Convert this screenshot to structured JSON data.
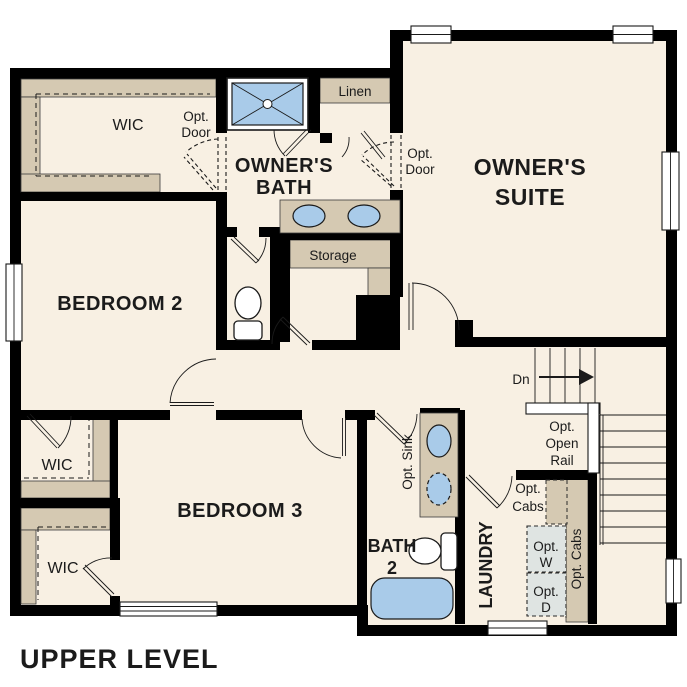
{
  "title": "UPPER LEVEL",
  "colors": {
    "background": "#ffffff",
    "floor": "#f8f0e3",
    "closet": "#d5c9b2",
    "wall": "#000000",
    "fixture_blue": "#a9cbe9",
    "appliance_gray": "#dfe4e2"
  },
  "rooms": {
    "owners_suite": {
      "l1": "OWNER'S",
      "l2": "SUITE"
    },
    "owners_bath": {
      "l1": "OWNER'S",
      "l2": "BATH"
    },
    "bedroom2": {
      "label": "BEDROOM 2"
    },
    "bedroom3": {
      "label": "BEDROOM 3"
    },
    "bath2": {
      "l1": "BATH",
      "l2": "2"
    },
    "laundry": {
      "label": "LAUNDRY"
    },
    "wic_top": {
      "label": "WIC"
    },
    "wic_middle": {
      "label": "WIC"
    },
    "wic_bottom": {
      "label": "WIC"
    },
    "linen": {
      "label": "Linen"
    },
    "storage": {
      "label": "Storage"
    }
  },
  "annotations": {
    "opt_door_wic": {
      "l1": "Opt.",
      "l2": "Door"
    },
    "opt_door_suite": {
      "l1": "Opt.",
      "l2": "Door"
    },
    "stairs_down": {
      "label": "Dn"
    },
    "opt_open_rail": {
      "l1": "Opt.",
      "l2": "Open",
      "l3": "Rail"
    },
    "opt_sink": {
      "label": "Opt. Sink"
    },
    "opt_cabs_laundry": {
      "l1": "Opt.",
      "l2": "Cabs"
    },
    "opt_washer": {
      "l1": "Opt.",
      "l2": "W"
    },
    "opt_dryer": {
      "l1": "Opt.",
      "l2": "D"
    },
    "opt_cabs_side": {
      "label": "Opt. Cabs"
    }
  }
}
